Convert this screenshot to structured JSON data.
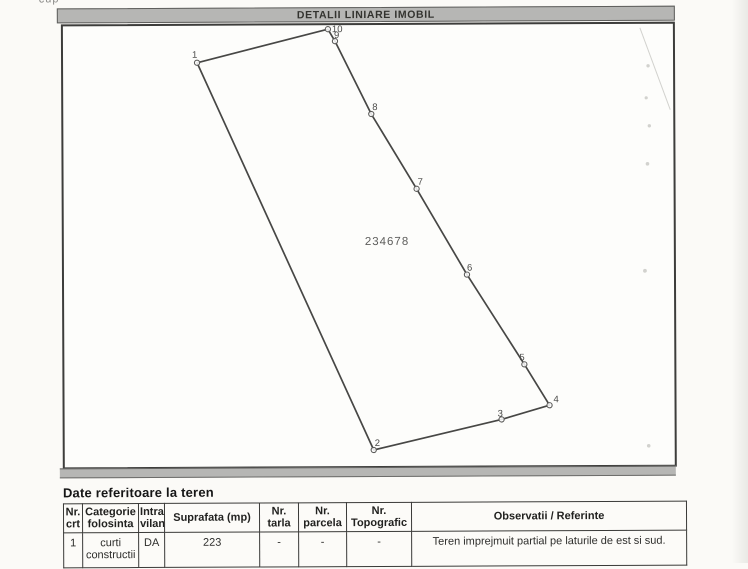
{
  "scan": {
    "top_fragment": "cup",
    "colors": {
      "bar_fill": "#b6b6b4",
      "line": "#474745",
      "paper": "#fbfaf7",
      "border": "#3a3a38"
    }
  },
  "header": {
    "title": "DETALII LINIARE IMOBIL"
  },
  "drawing": {
    "parcel_number": "234678",
    "parcel_label": {
      "x": 301,
      "y": 220
    },
    "path_order": [
      "1",
      "10",
      "9",
      "8",
      "7",
      "6",
      "5",
      "4",
      "3",
      "2"
    ],
    "vertices": [
      {
        "n": "1",
        "x": 134,
        "y": 37,
        "lx": 129,
        "ly": 32
      },
      {
        "n": "10",
        "x": 265,
        "y": 4,
        "lx": 269,
        "ly": 7
      },
      {
        "n": "9",
        "x": 272,
        "y": 16,
        "lx": 271,
        "ly": 13
      },
      {
        "n": "8",
        "x": 308,
        "y": 89,
        "lx": 309,
        "ly": 85
      },
      {
        "n": "7",
        "x": 353,
        "y": 164,
        "lx": 354,
        "ly": 160
      },
      {
        "n": "6",
        "x": 403,
        "y": 250,
        "lx": 403,
        "ly": 246
      },
      {
        "n": "5",
        "x": 460,
        "y": 340,
        "lx": 455,
        "ly": 336
      },
      {
        "n": "4",
        "x": 485,
        "y": 381,
        "lx": 489,
        "ly": 378
      },
      {
        "n": "3",
        "x": 437,
        "y": 395,
        "lx": 433,
        "ly": 392
      },
      {
        "n": "2",
        "x": 309,
        "y": 425,
        "lx": 310,
        "ly": 421
      }
    ]
  },
  "section": {
    "title": "Date referitoare la teren"
  },
  "table": {
    "headers": [
      "Nr.\ncrt",
      "Categorie\nfolosinta",
      "Intra\nvilan",
      "Suprafata (mp)",
      "Nr.\ntarla",
      "Nr.\nparcela",
      "Nr.\nTopografic",
      "Observatii / Referinte"
    ],
    "rows": [
      [
        "1",
        "curti\nconstructii",
        "DA",
        "223",
        "-",
        "-",
        "-",
        "Teren imprejmuit partial pe laturile de est si sud."
      ]
    ]
  }
}
